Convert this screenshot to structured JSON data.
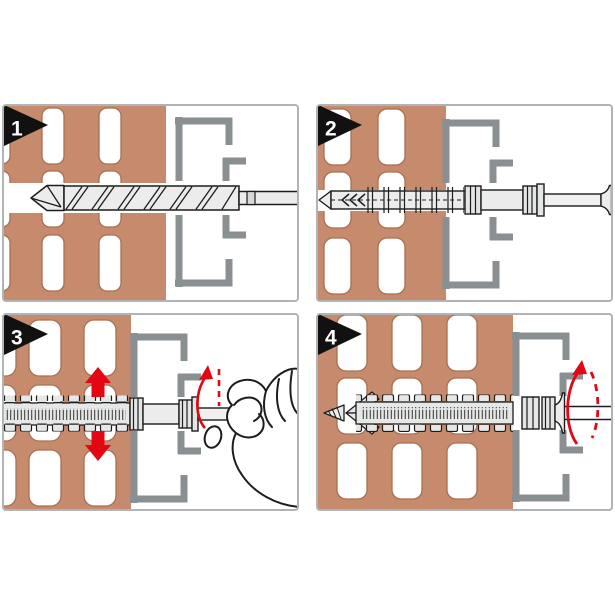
{
  "figure": {
    "kind": "installation-instruction-diagram",
    "panels": [
      {
        "step": "1",
        "graphics": [
          "perforated-brick-wall",
          "frame-profile",
          "drill-bit"
        ]
      },
      {
        "step": "2",
        "graphics": [
          "perforated-brick-wall",
          "frame-profile",
          "frame-anchor",
          "countersunk-screw"
        ]
      },
      {
        "step": "3",
        "graphics": [
          "perforated-brick-wall",
          "frame-profile",
          "expanded-anchor",
          "screw",
          "gripping-hand",
          "up-arrow",
          "down-arrow",
          "rotation-arrow"
        ]
      },
      {
        "step": "4",
        "graphics": [
          "perforated-brick-wall",
          "frame-profile",
          "expanded-anchor",
          "countersunk-screw-head",
          "rotation-arrow"
        ]
      }
    ]
  },
  "colors": {
    "background": "#ffffff",
    "brick": "#c68a6c",
    "brick_outline": "#a96f52",
    "frame_gray": "#8a8f92",
    "panel_border": "#b0b4b6",
    "arrow_red": "#e30613",
    "outline": "#1d1d1b",
    "part_fill": "#ececec",
    "band_fill": "#e6e7e7",
    "badge_black": "#111111",
    "badge_text": "#ffffff"
  }
}
